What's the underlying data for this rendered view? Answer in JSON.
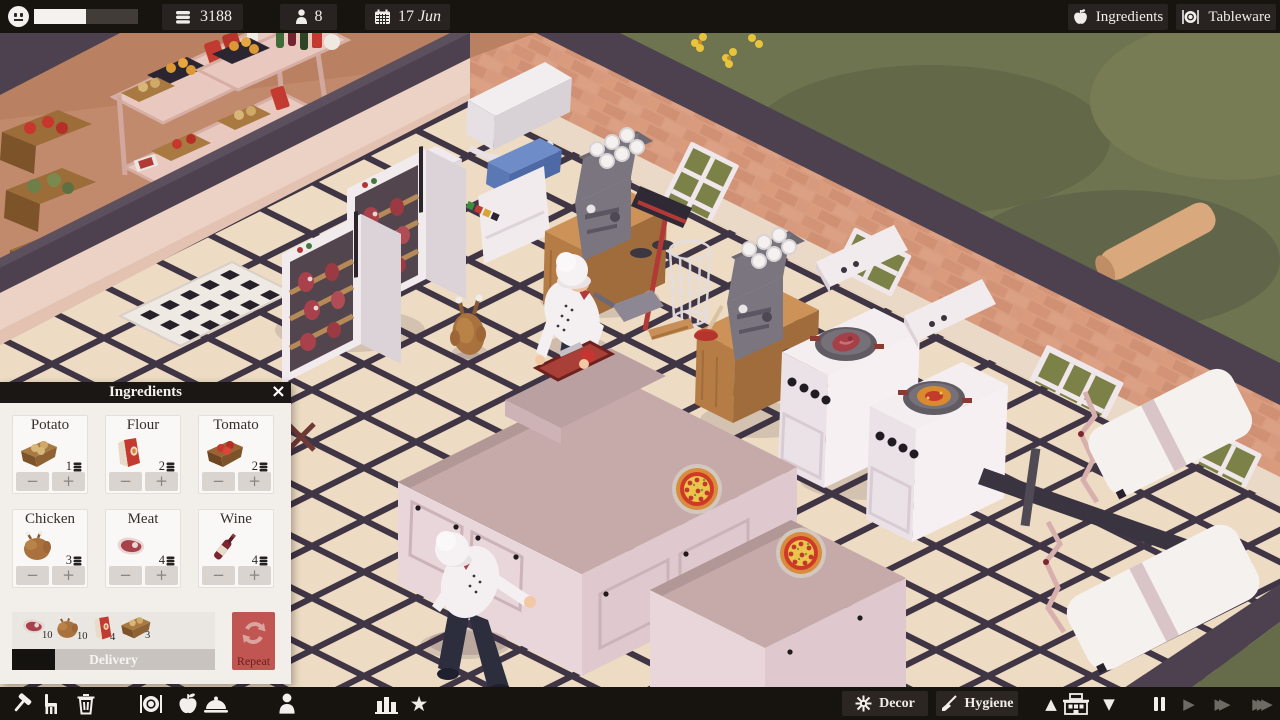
{
  "topbar": {
    "mood": {
      "progress": 0.5
    },
    "money": "3188",
    "staff_count": "8",
    "date_day": "17",
    "date_month": "Jun",
    "ingredients_button": "Ingredients",
    "tableware_button": "Tableware"
  },
  "ingredients_panel": {
    "title": "Ingredients",
    "close_glyph": "×",
    "minus_glyph": "−",
    "plus_glyph": "+",
    "items": [
      {
        "name": "Potato",
        "count": "1"
      },
      {
        "name": "Flour",
        "count": "2"
      },
      {
        "name": "Tomato",
        "count": "2"
      },
      {
        "name": "Chicken",
        "count": "3"
      },
      {
        "name": "Meat",
        "count": "4"
      },
      {
        "name": "Wine",
        "count": "4"
      }
    ],
    "delivery": {
      "label": "Delivery",
      "progress": 0.21,
      "repeat_label": "Repeat",
      "cart": [
        {
          "item": "meat",
          "count": "10"
        },
        {
          "item": "chicken",
          "count": "10"
        },
        {
          "item": "flour",
          "count": "4"
        },
        {
          "item": "potato",
          "count": "3"
        }
      ]
    }
  },
  "bottombar": {
    "decor_label": "Decor",
    "hygiene_label": "Hygiene",
    "star_glyph": "★",
    "up_glyph": "▲",
    "down_glyph": "▼",
    "play_glyph": "▶",
    "ff_glyph": "▶▶",
    "fff_glyph": "▶▶▶"
  },
  "icons": {
    "mood": "neutral-smiley",
    "money": "coin-stack",
    "staff": "person",
    "date": "calendar",
    "toolbar_left": [
      "hammer",
      "chair",
      "trash",
      "tableware-plate",
      "ingredients-apple",
      "menu-cloche",
      "staff-person",
      "stats-chart",
      "reviews-star"
    ],
    "decor": "ornament-snowflake",
    "hygiene": "broom",
    "floor_selector": [
      "up-triangle",
      "building",
      "down-triangle"
    ],
    "speed_controls": [
      "pause",
      "play",
      "fast-forward",
      "fastest-forward"
    ]
  },
  "colors": {
    "bar-bg": "#17130f",
    "box-bg": "#282320",
    "panel-bg": "#f2eeea",
    "header-bg": "#1b1714",
    "card-bg": "#faf8f6",
    "stepper-bg": "#d9d4cf",
    "repeat-red": "#c05551",
    "delivery-fill": "#151310"
  }
}
